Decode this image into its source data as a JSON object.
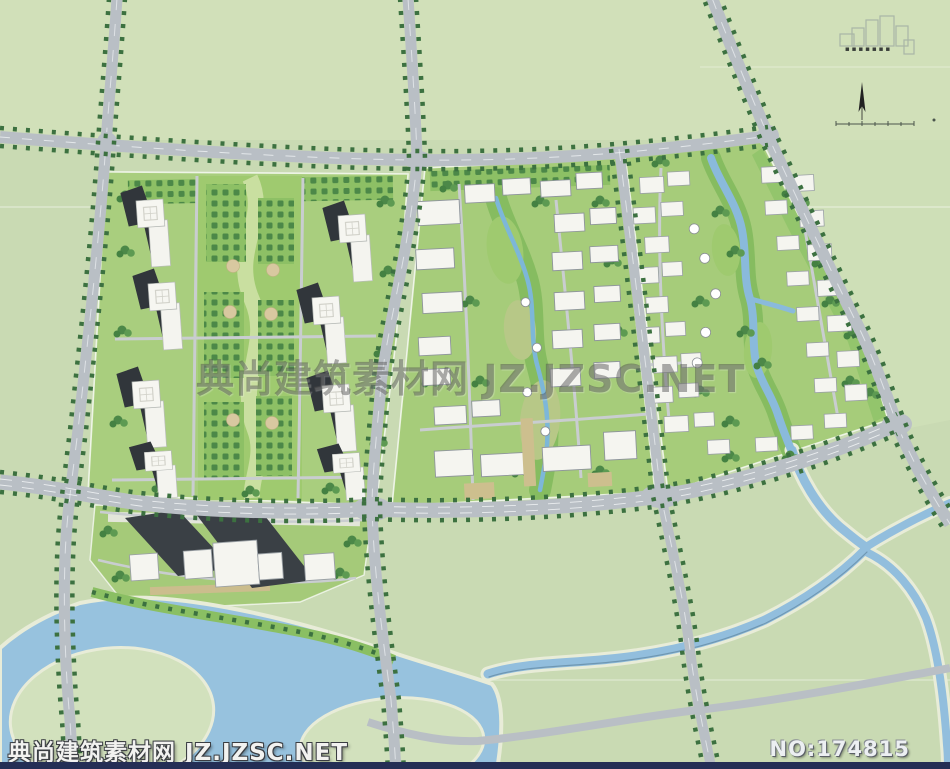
{
  "watermark": {
    "center": "典尚建筑素材网 JZ.JZSC.NET",
    "footer_left": "典尚建筑素材网 JZ.JZSC.NET",
    "footer_right": "NO:174815"
  },
  "header": {
    "company_glyphs": "▪▪▪▪▪▪▪"
  },
  "colors": {
    "grass": "#c9dab3",
    "block_lawn": "#a9ce7e",
    "park_green": "#9fca6f",
    "tree_dark": "#41793f",
    "road_gray": "#bac0c6",
    "water_blue": "#92bedd",
    "creek_blue": "#7db7d8",
    "building_white": "#f5f5f0",
    "shadow_dark": "#31363b",
    "plaza_tan": "#d8c8a0",
    "bottom_bar_navy": "#242e55"
  }
}
